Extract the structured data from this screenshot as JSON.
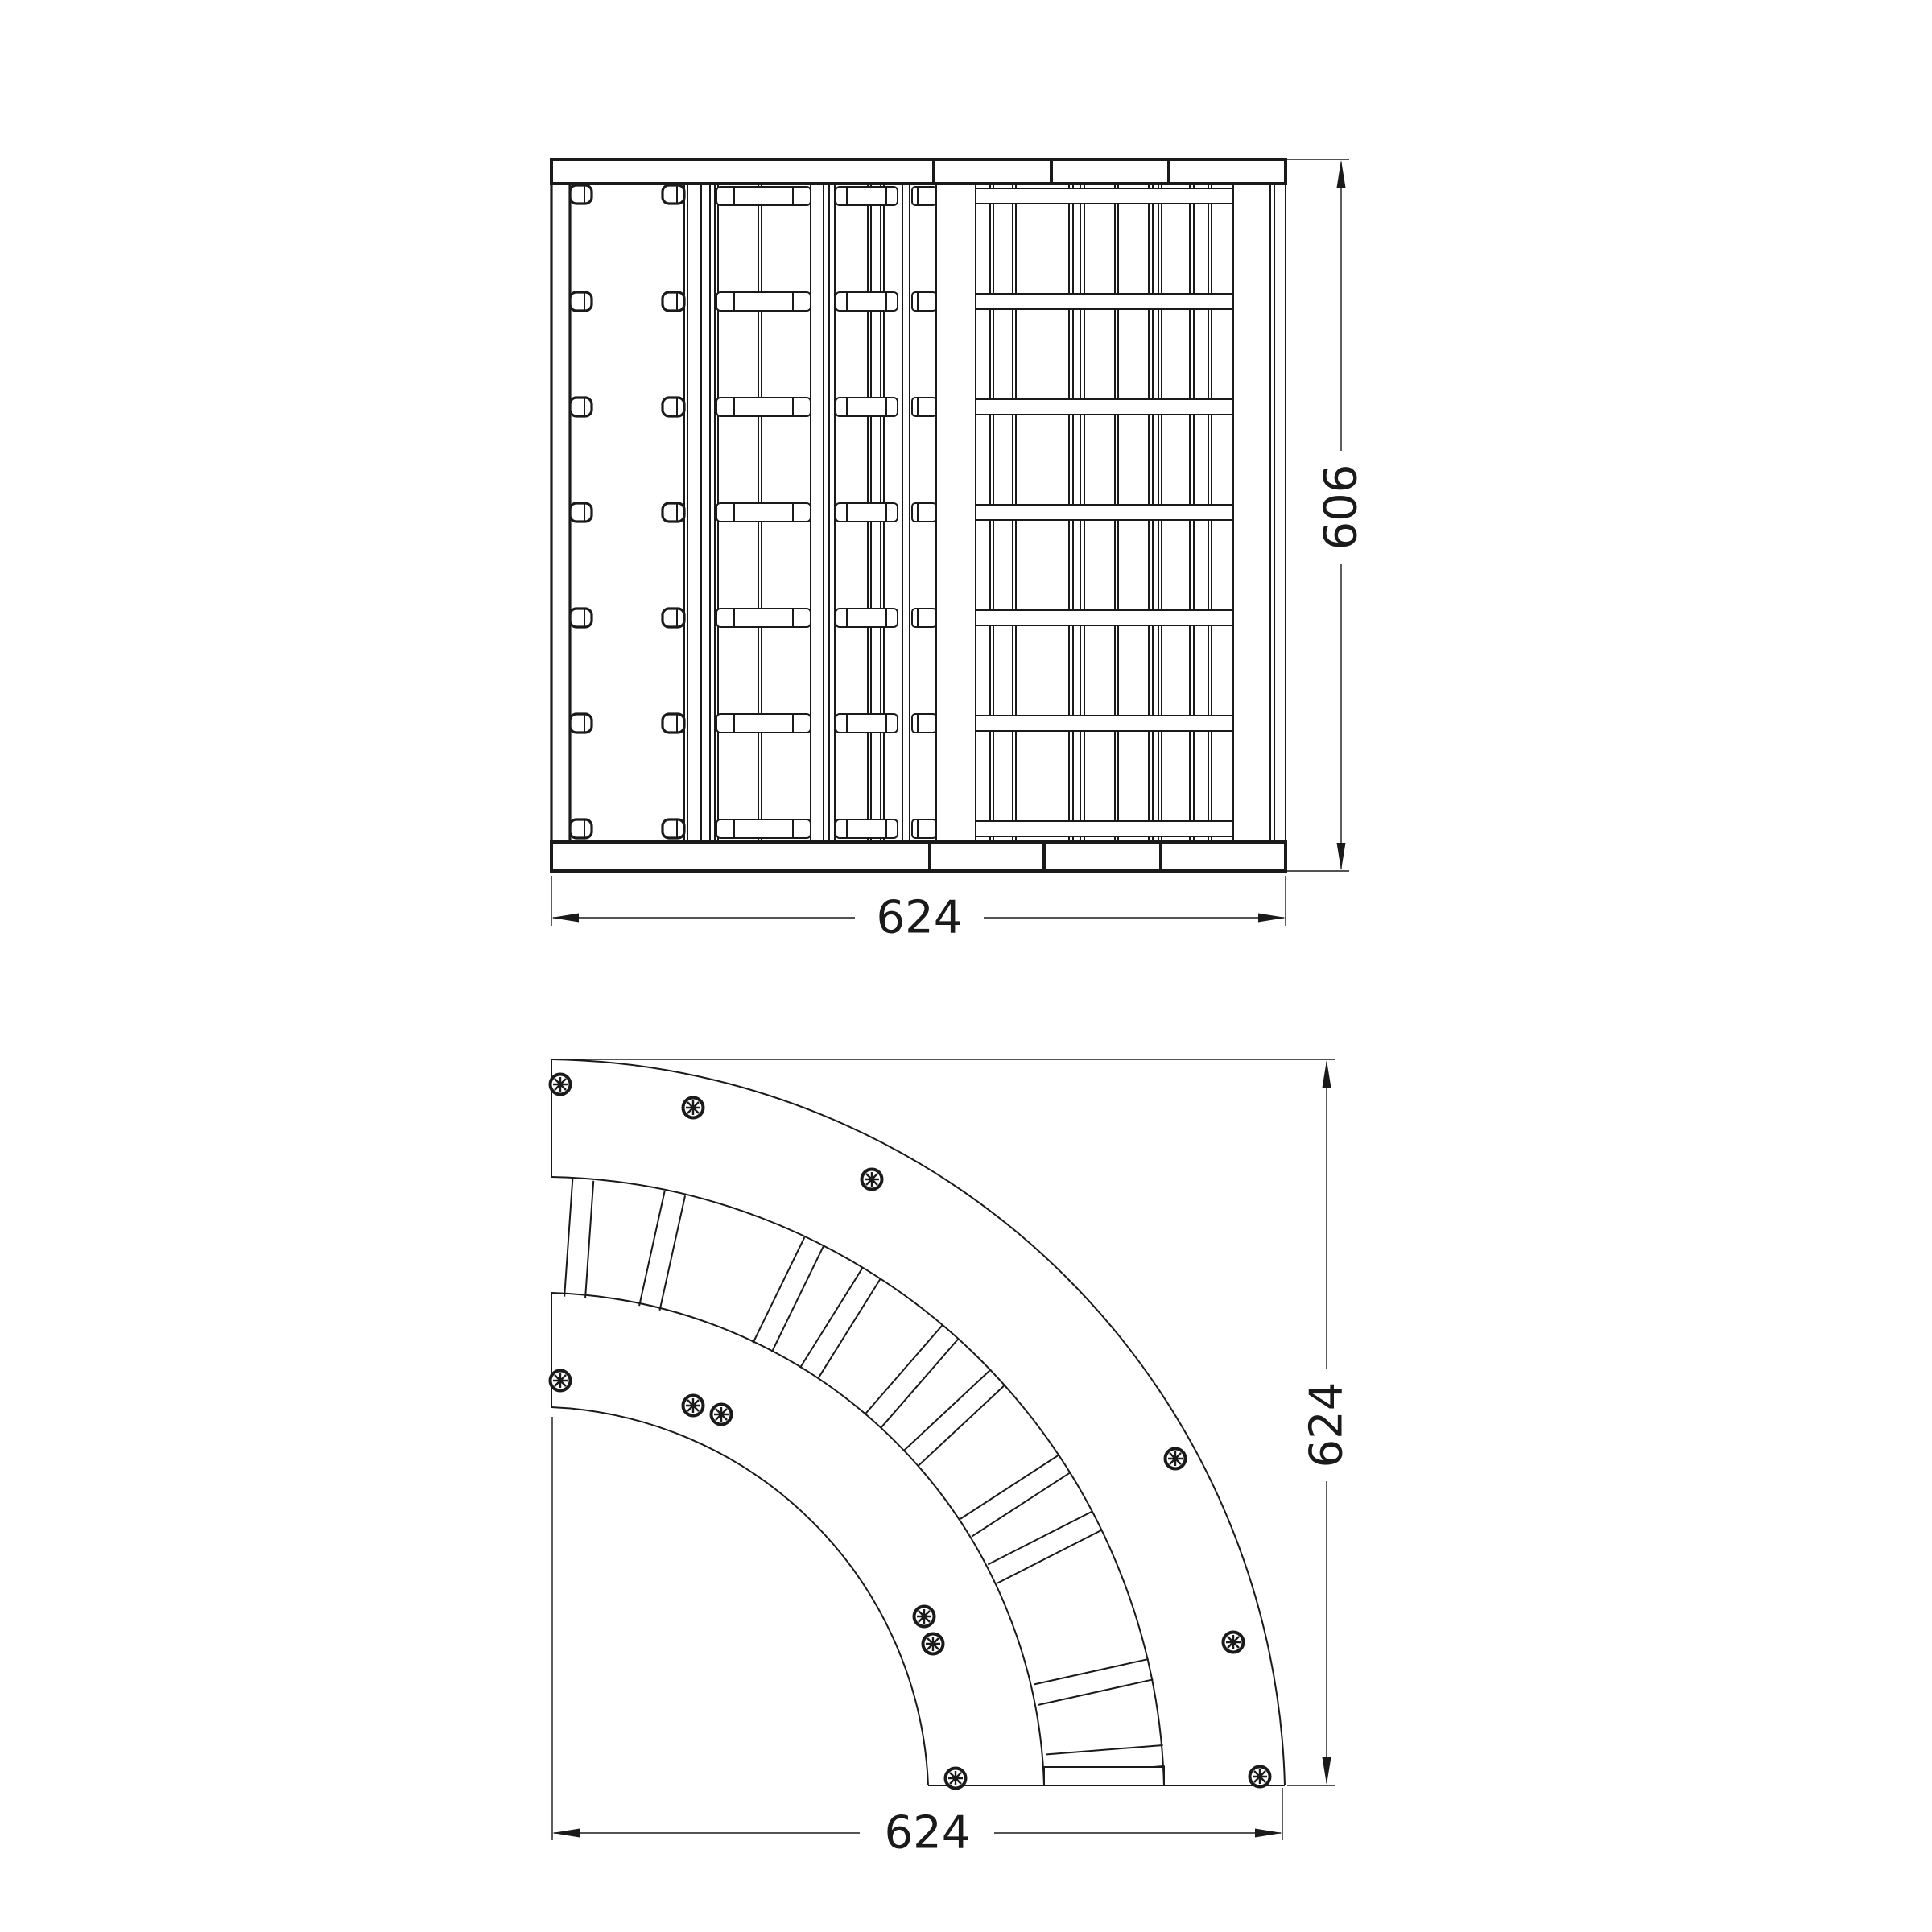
{
  "page": {
    "background_color": "#ffffff",
    "line_color": "#1a1a1a",
    "drawing_type": "CAD technical drawing - curved corner rack, two orthographic views"
  },
  "dims": {
    "elevation_width": "624",
    "elevation_height": "606",
    "plan_width": "624",
    "plan_height": "624"
  },
  "elevation": {
    "top_bar_segments": 4,
    "bottom_bar_segments": 4,
    "shelf_rows": 7,
    "clip_columns": 2
  },
  "plan": {
    "shape": "quarter-annulus",
    "outer_band_screws": 6,
    "inner_band_screws": 6,
    "rungs": 10
  }
}
